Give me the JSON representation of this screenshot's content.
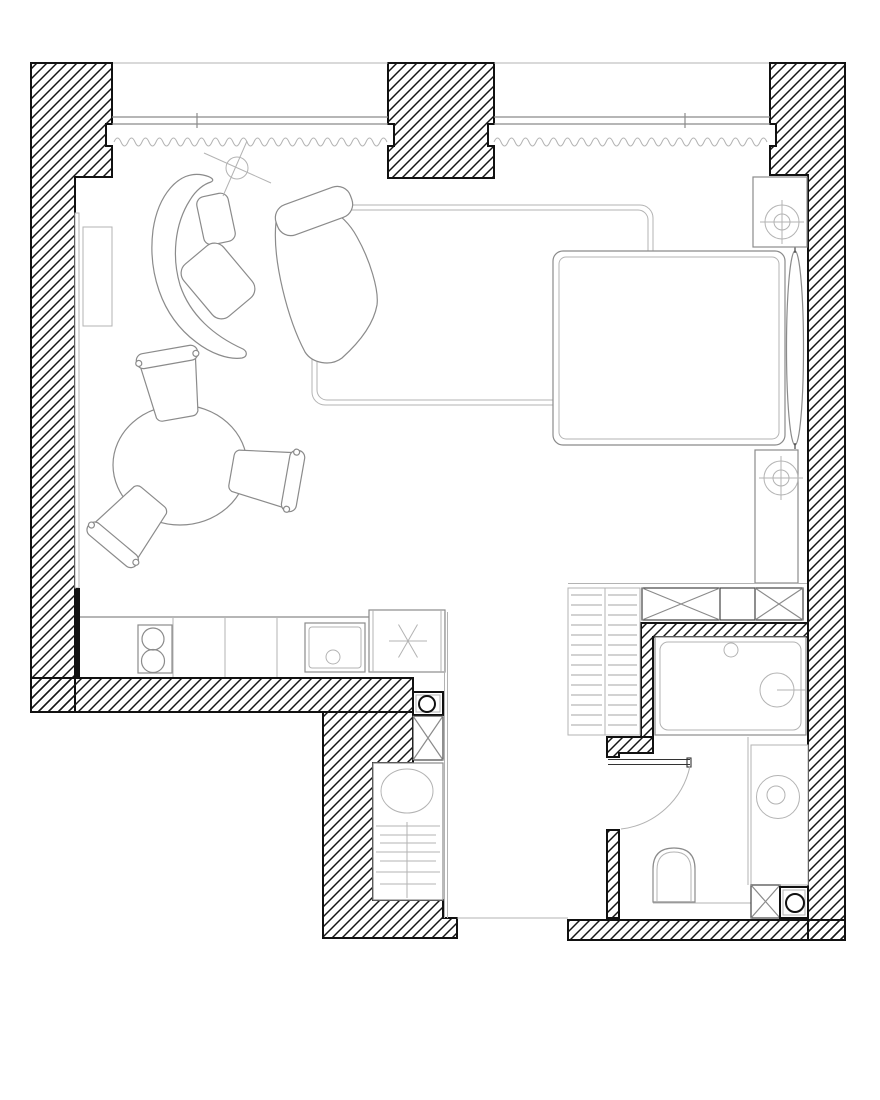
{
  "page": {
    "title": "Studio apartment floor plan"
  },
  "colors": {
    "background": "#ffffff",
    "wall_line": "#111111",
    "hatch_line": "#161616",
    "furniture_line": "#8b8b8b",
    "light_line": "#b3b3b3",
    "detail_line": "#333333"
  },
  "plan": {
    "wall_style": "diagonal-hatch",
    "window": {
      "segments": 2,
      "drape_symbol": "wavy-line",
      "mullion_ticks": 2
    },
    "rooms": [
      {
        "name": "living-sleeping-area",
        "items": [
          "chaise-longue",
          "wing-armchair",
          "back-cushion",
          "seat-cushion",
          "floor-lamp",
          "rug",
          "double-bed",
          "bolster-pillow",
          "nightstand-with-reading-lamp",
          "bedside-column-with-reading-lamp",
          "wall-ledge",
          "side-cabinet",
          "round-dining-table",
          "dining-chair-top",
          "dining-chair-right",
          "dining-chair-bottom-left"
        ]
      },
      {
        "name": "kitchen",
        "items": [
          "counter-end-panel",
          "kitchen-counter",
          "cooktop-two-burners",
          "kitchen-sink-with-drain",
          "tall-cabinet-freezer-symbol"
        ]
      },
      {
        "name": "hallway-utility",
        "items": [
          "meter-box-with-gauge",
          "ventilation-shaft",
          "washing-machine",
          "drying-rack-shelves",
          "shelf-unit-two-columns",
          "built-in-closet-row",
          "entrance-opening"
        ]
      },
      {
        "name": "bathroom",
        "items": [
          "shower-tray",
          "shower-head",
          "floor-drain",
          "washbasin-counter",
          "round-washbasin",
          "toilet",
          "swing-door",
          "ventilation-shaft",
          "meter-box-with-gauge"
        ]
      }
    ]
  }
}
